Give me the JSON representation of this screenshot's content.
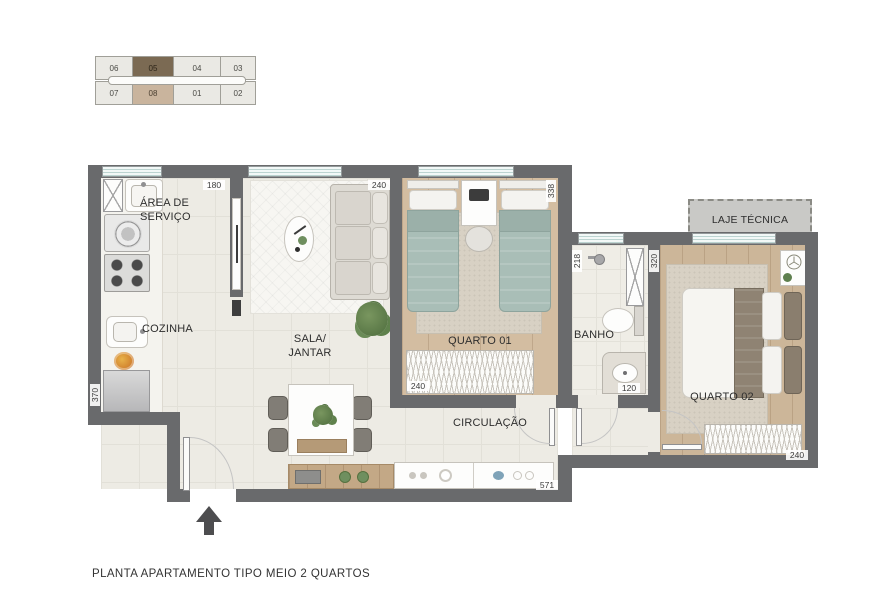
{
  "title": "PLANTA APARTAMENTO TIPO MEIO 2 QUARTOS",
  "key_plan": {
    "units": [
      {
        "label": "06"
      },
      {
        "label": "05",
        "state": "primary"
      },
      {
        "label": "04"
      },
      {
        "label": "03"
      },
      {
        "label": "07"
      },
      {
        "label": "08",
        "state": "secondary"
      },
      {
        "label": "01"
      },
      {
        "label": "02"
      }
    ]
  },
  "rooms": {
    "area_servico": "ÁREA DE\nSERVIÇO",
    "cozinha": "COZINHA",
    "sala": "SALA/\nJANTAR",
    "quarto1": "QUARTO 01",
    "banho": "BANHO",
    "circulacao": "CIRCULAÇÃO",
    "quarto2": "QUARTO 02",
    "laje_tecnica": "LAJE TÉCNICA"
  },
  "dimensions_cm": {
    "servico_width": "180",
    "sala_width": "240",
    "quarto1_depth": "338",
    "quarto1_wardrobe": "240",
    "banho_depth": "218",
    "banho_width": "120",
    "quarto2_depth": "320",
    "quarto2_width": "240",
    "cozinha_depth": "370",
    "circulacao_length": "571"
  },
  "colors": {
    "wall": "#696a6c",
    "floor_tile": "#edebe4",
    "floor_wood": "#d2bb9e",
    "bed_teal": "#a9beb7",
    "rug": "#d8d1c4",
    "unit_primary": "#7b6a53",
    "unit_secondary": "#c9b49d",
    "laje_fill": "#c9c9c6",
    "window_glass": "#f2f8f7"
  },
  "icons": {
    "north_arrow": "▲",
    "fan_decor": "fan",
    "plant": "plant"
  }
}
